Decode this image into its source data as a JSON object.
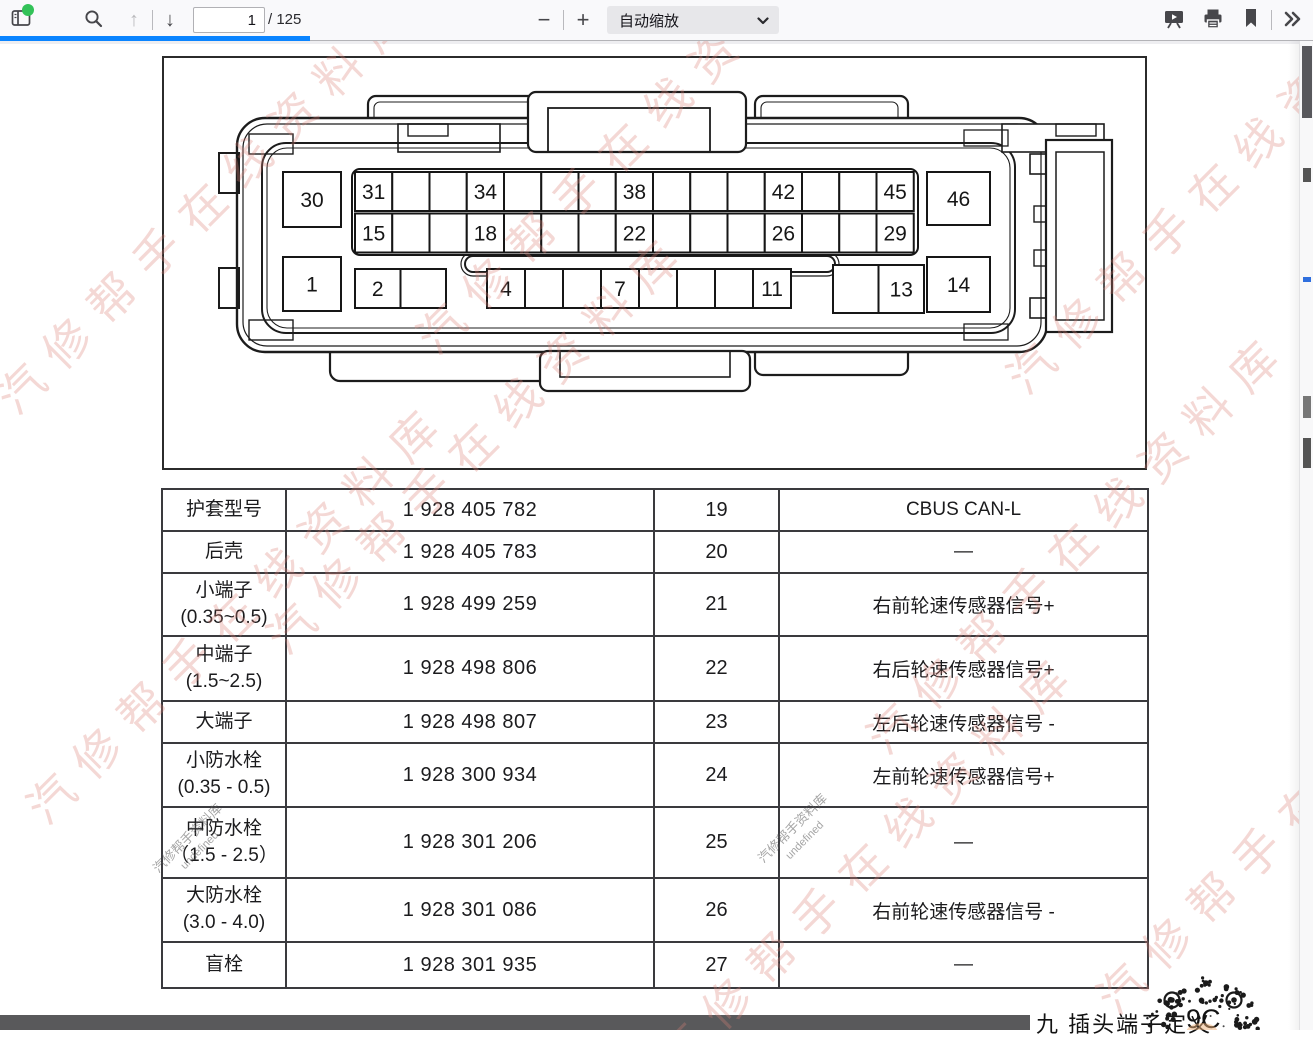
{
  "toolbar": {
    "page_current": "1",
    "page_total_label": "/ 125",
    "zoom_label": "自动缩放",
    "zoom_out_glyph": "−",
    "zoom_in_glyph": "+",
    "prev_glyph": "↑",
    "next_glyph": "↓"
  },
  "figure": {
    "connector": {
      "corner_pins": [
        {
          "label": "30",
          "x": 119,
          "y": 114,
          "w": 58,
          "h": 55
        },
        {
          "label": "1",
          "x": 119,
          "y": 199,
          "w": 58,
          "h": 54
        },
        {
          "label": "46",
          "x": 763,
          "y": 114,
          "w": 63,
          "h": 53
        },
        {
          "label": "14",
          "x": 763,
          "y": 199,
          "w": 63,
          "h": 55
        }
      ],
      "rows": [
        {
          "x": 191,
          "y": 114,
          "cellW": 37.25,
          "cellH": 39,
          "cells": 15,
          "labels": {
            "0": "31",
            "3": "34",
            "7": "38",
            "11": "42",
            "14": "45"
          }
        },
        {
          "x": 191,
          "y": 155.5,
          "cellW": 37.25,
          "cellH": 39,
          "cells": 15,
          "labels": {
            "0": "15",
            "3": "18",
            "7": "22",
            "11": "26",
            "14": "29"
          }
        },
        {
          "x": 191,
          "y": 211,
          "cellW": 45.5,
          "cellH": 39,
          "cells": 2,
          "labels": {
            "0": "2"
          }
        },
        {
          "x": 323,
          "y": 211,
          "cellW": 38,
          "cellH": 39,
          "cells": 8,
          "labels": {
            "0": "4",
            "3": "7",
            "7": "11"
          }
        },
        {
          "x": 669,
          "y": 207,
          "cellW": 45.5,
          "cellH": 48,
          "cells": 2,
          "labels": {
            "1": "13"
          }
        }
      ]
    }
  },
  "table": {
    "rows": [
      {
        "label": "护套型号",
        "label2": "",
        "part": "1 928 405 782",
        "pin": "19",
        "func": "CBUS CAN-L"
      },
      {
        "label": "后壳",
        "label2": "",
        "part": "1 928 405 783",
        "pin": "20",
        "func": "—"
      },
      {
        "label": "小端子",
        "label2": "(0.35~0.5)",
        "part": "1 928 499 259",
        "pin": "21",
        "func": "右前轮速传感器信号+"
      },
      {
        "label": "中端子",
        "label2": "(1.5~2.5)",
        "part": "1 928 498 806",
        "pin": "22",
        "func": "右后轮速传感器信号+"
      },
      {
        "label": "大端子",
        "label2": "",
        "part": "1 928 498 807",
        "pin": "23",
        "func": "左后轮速传感器信号 -"
      },
      {
        "label": "小防水栓",
        "label2": "(0.35 - 0.5)",
        "part": "1 928 300 934",
        "pin": "24",
        "func": "左前轮速传感器信号+"
      },
      {
        "label": "中防水栓",
        "label2": "（1.5 - 2.5）",
        "part": "1 928 301 206",
        "pin": "25",
        "func": "—"
      },
      {
        "label": "大防水栓",
        "label2": "(3.0 - 4.0)",
        "part": "1 928 301 086",
        "pin": "26",
        "func": "右前轮速传感器信号 -"
      },
      {
        "label": "盲栓",
        "label2": "",
        "part": "1 928 301 935",
        "pin": "27",
        "func": "—"
      }
    ]
  },
  "watermark": {
    "text": "汽修帮手在线资料库",
    "color": "#db8177",
    "instances": [
      [
        -20,
        380
      ],
      [
        10,
        790
      ],
      [
        250,
        620
      ],
      [
        400,
        320
      ],
      [
        640,
        1040
      ],
      [
        850,
        720
      ],
      [
        990,
        360
      ],
      [
        1080,
        980
      ]
    ],
    "gray_text": "汽修帮手资料库",
    "gray_sub": "undefined",
    "gray_instances": [
      [
        755,
        855
      ],
      [
        150,
        865
      ]
    ]
  },
  "footer": {
    "section_title": "九 插头端子定义",
    "page_code": "9C"
  }
}
